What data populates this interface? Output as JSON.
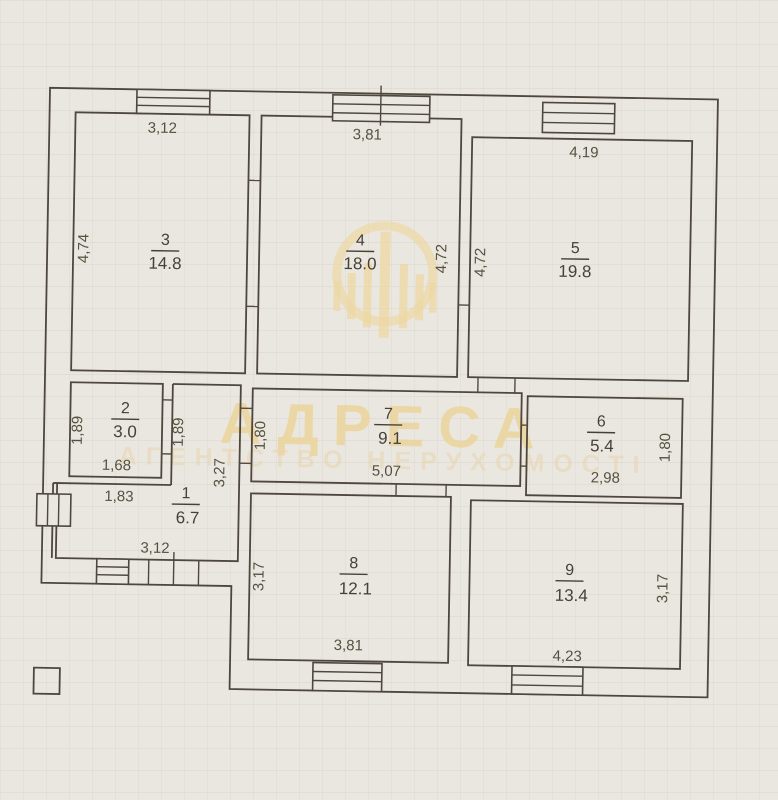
{
  "watermark": {
    "brand": "АДРЕСА",
    "tagline": "АГЕНТСТВО НЕРУХОМОСТІ",
    "color": "#edd7a2"
  },
  "plan": {
    "paper_color": "#eae7e0",
    "line_color": "#4f473d",
    "rooms": [
      {
        "number": "1",
        "area": "6.7",
        "dims": {
          "top": "1,83",
          "right": "3,27",
          "bottom": "3,12"
        }
      },
      {
        "number": "2",
        "area": "3.0",
        "dims": {
          "left": "1,89",
          "right": "1,89",
          "bottom": "1,68"
        }
      },
      {
        "number": "3",
        "area": "14.8",
        "dims": {
          "top": "3,12",
          "left": "4,74"
        }
      },
      {
        "number": "4",
        "area": "18.0",
        "dims": {
          "top": "3,81",
          "right": "4,72"
        }
      },
      {
        "number": "5",
        "area": "19.8",
        "dims": {
          "top": "4,19",
          "left": "4,72"
        }
      },
      {
        "number": "6",
        "area": "5.4",
        "dims": {
          "right": "1,80",
          "bottom": "2,98"
        }
      },
      {
        "number": "7",
        "area": "9.1",
        "dims": {
          "left": "1,80",
          "bottom": "5,07"
        }
      },
      {
        "number": "8",
        "area": "12.1",
        "dims": {
          "left": "3,17",
          "bottom": "3,81"
        }
      },
      {
        "number": "9",
        "area": "13.4",
        "dims": {
          "right": "3,17",
          "bottom": "4,23"
        }
      }
    ]
  }
}
